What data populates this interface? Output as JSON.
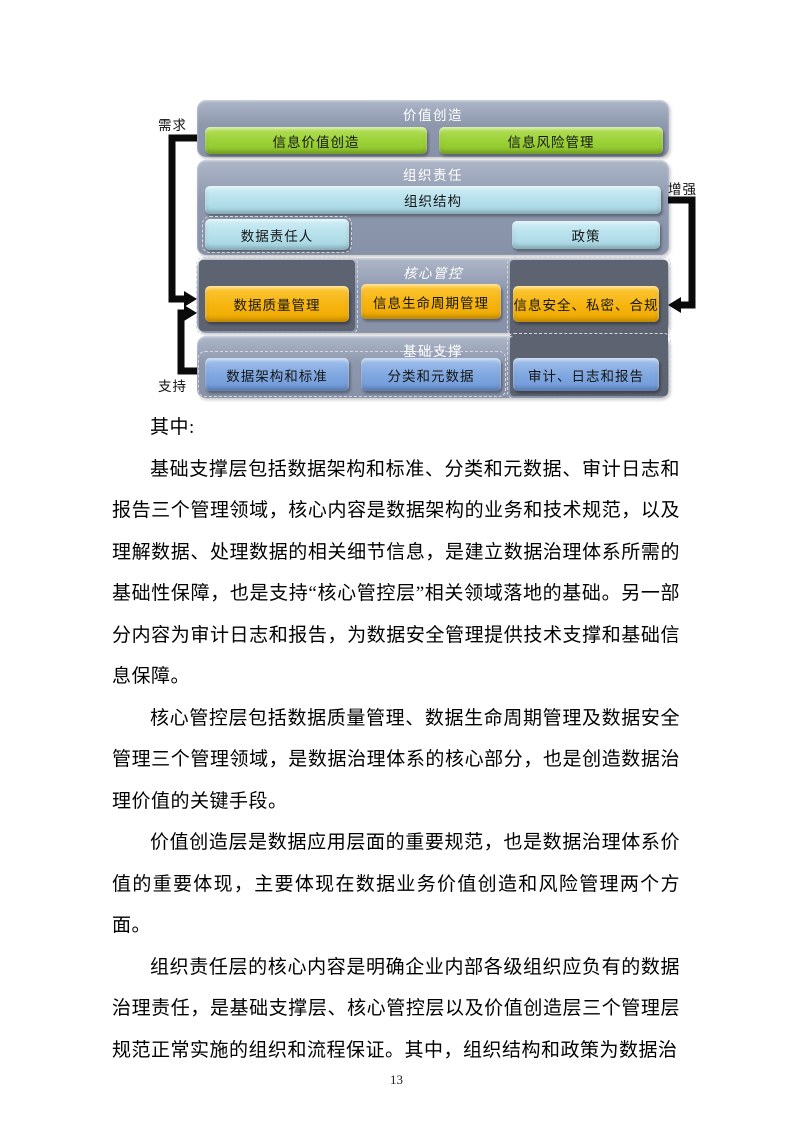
{
  "page": {
    "number": "13"
  },
  "diagram": {
    "side_labels": {
      "demand": "需求",
      "enhance": "增强",
      "support": "支持"
    },
    "layers": [
      {
        "title": "价值创造",
        "boxes": [
          "信息价值创造",
          "信息风险管理"
        ]
      },
      {
        "title": "组织责任",
        "boxes": [
          "组织结构",
          "数据责任人",
          "政策"
        ]
      },
      {
        "title": "核心管控",
        "boxes": [
          "数据质量管理",
          "信息生命周期管理",
          "信息安全、私密、合规"
        ]
      },
      {
        "title": "基础支撑",
        "boxes": [
          "数据架构和标准",
          "分类和元数据",
          "审计、日志和报告"
        ]
      }
    ],
    "colors": {
      "layer_background": "#8d97ad",
      "value_creation_box": "#9ad136",
      "organization_box": "#b4dfeb",
      "core_control_box": "#f6b40e",
      "foundation_box": "#7ea6e0",
      "dark_band": "#5d6370",
      "arrow": "#0a0a0a"
    }
  },
  "body": {
    "intro": "其中:",
    "paragraphs": [
      "基础支撑层包括数据架构和标准、分类和元数据、审计日志和报告三个管理领域，核心内容是数据架构的业务和技术规范，以及理解数据、处理数据的相关细节信息，是建立数据治理体系所需的基础性保障，也是支持“核心管控层”相关领域落地的基础。另一部分内容为审计日志和报告，为数据安全管理提供技术支撑和基础信息保障。",
      "核心管控层包括数据质量管理、数据生命周期管理及数据安全管理三个管理领域，是数据治理体系的核心部分，也是创造数据治理价值的关键手段。",
      "价值创造层是数据应用层面的重要规范，也是数据治理体系价值的重要体现，主要体现在数据业务价值创造和风险管理两个方面。",
      "组织责任层的核心内容是明确企业内部各级组织应负有的数据治理责任，是基础支撑层、核心管控层以及价值创造层三个管理层规范正常实施的组织和流程保证。其中，组织结构和政策为数据治"
    ]
  }
}
